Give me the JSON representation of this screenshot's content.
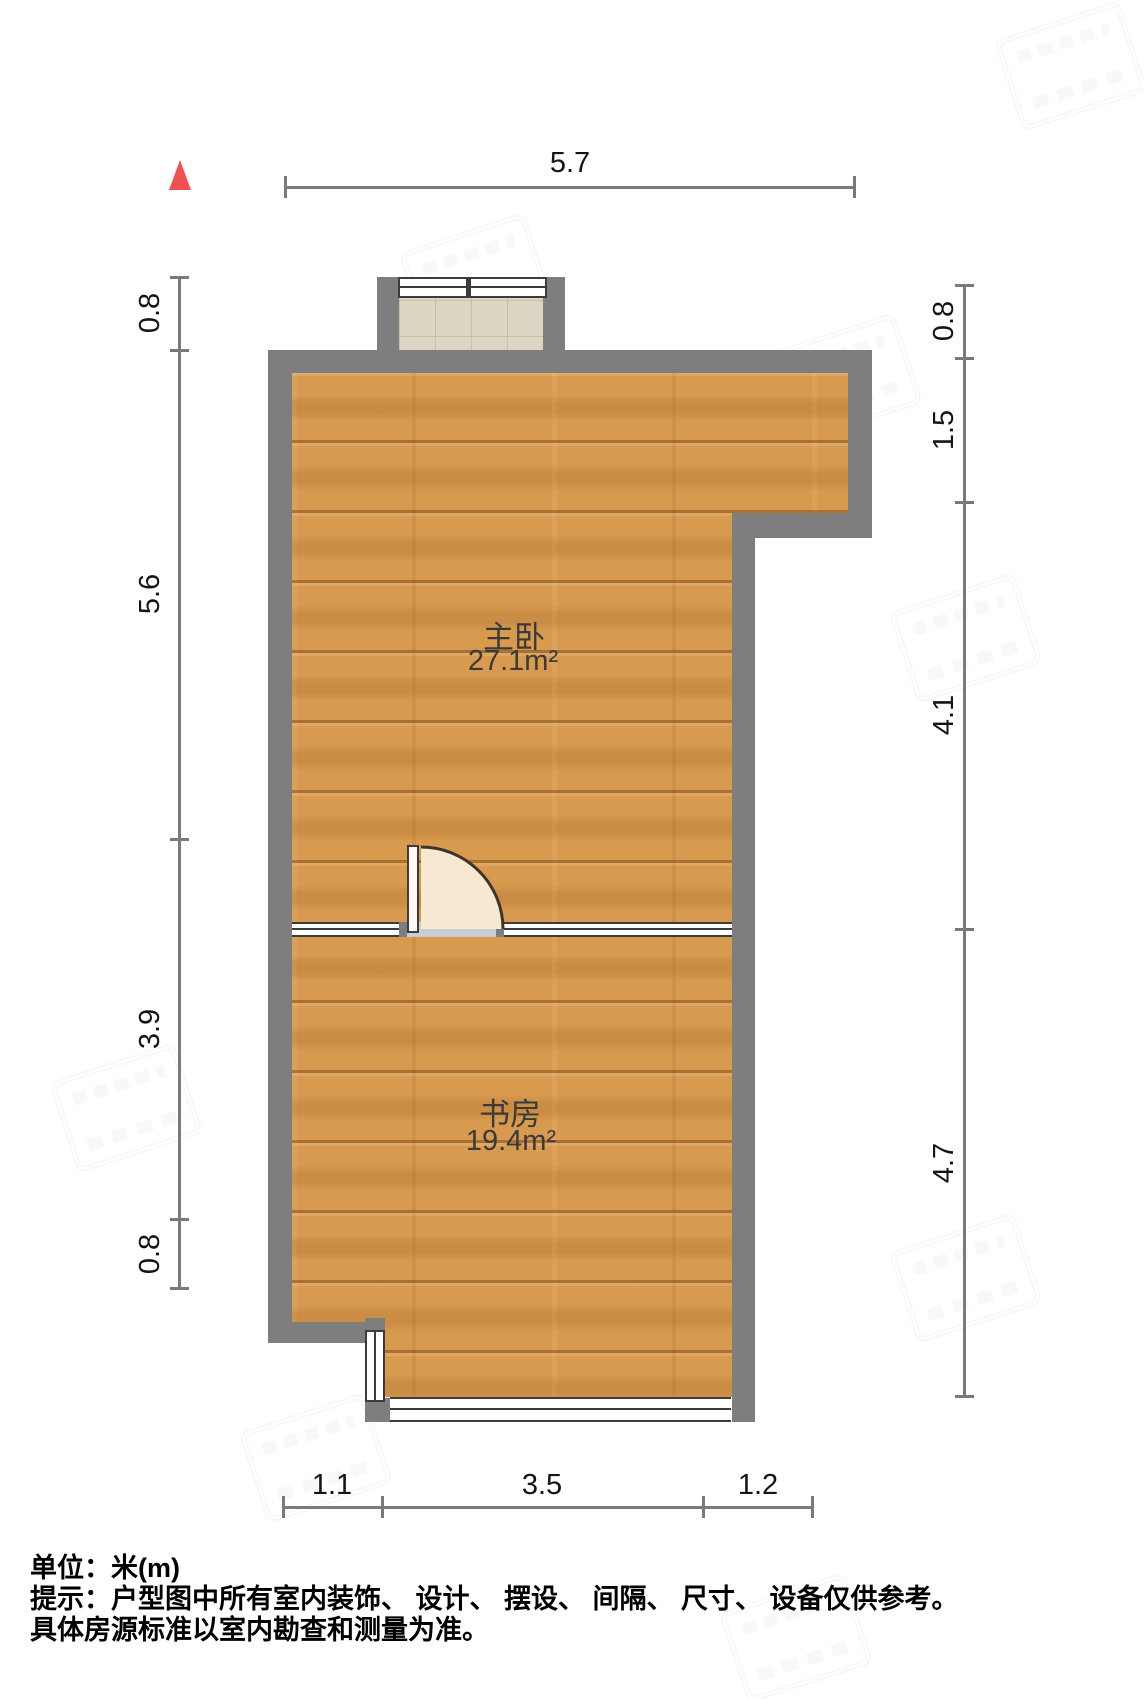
{
  "rooms": [
    {
      "name": "主卧",
      "area": "27.1m²"
    },
    {
      "name": "书房",
      "area": "19.4m²"
    }
  ],
  "dimensions": {
    "top": [
      "5.7"
    ],
    "left": [
      "0.8",
      "5.6",
      "3.9",
      "0.8"
    ],
    "right": [
      "0.8",
      "1.5",
      "4.1",
      "4.7"
    ],
    "bottom": [
      "1.1",
      "3.5",
      "1.2"
    ]
  },
  "footer": {
    "unit": "单位：米(m)",
    "notice": "提示：户型图中所有室内装饰、 设计、 摆设、 间隔、 尺寸、 设备仅供参考。",
    "notice2": "具体房源标准以室内勘查和测量为准。"
  },
  "icons": {
    "north": "north-arrow"
  },
  "colors": {
    "wall": "#7e7e7e",
    "wood_floor": "#d89a4e",
    "tile_floor": "#dbd5c1",
    "door_leaf": "#f7e8d1",
    "north_arrow": "#f05050",
    "dimension_line": "#7a7a7a"
  }
}
